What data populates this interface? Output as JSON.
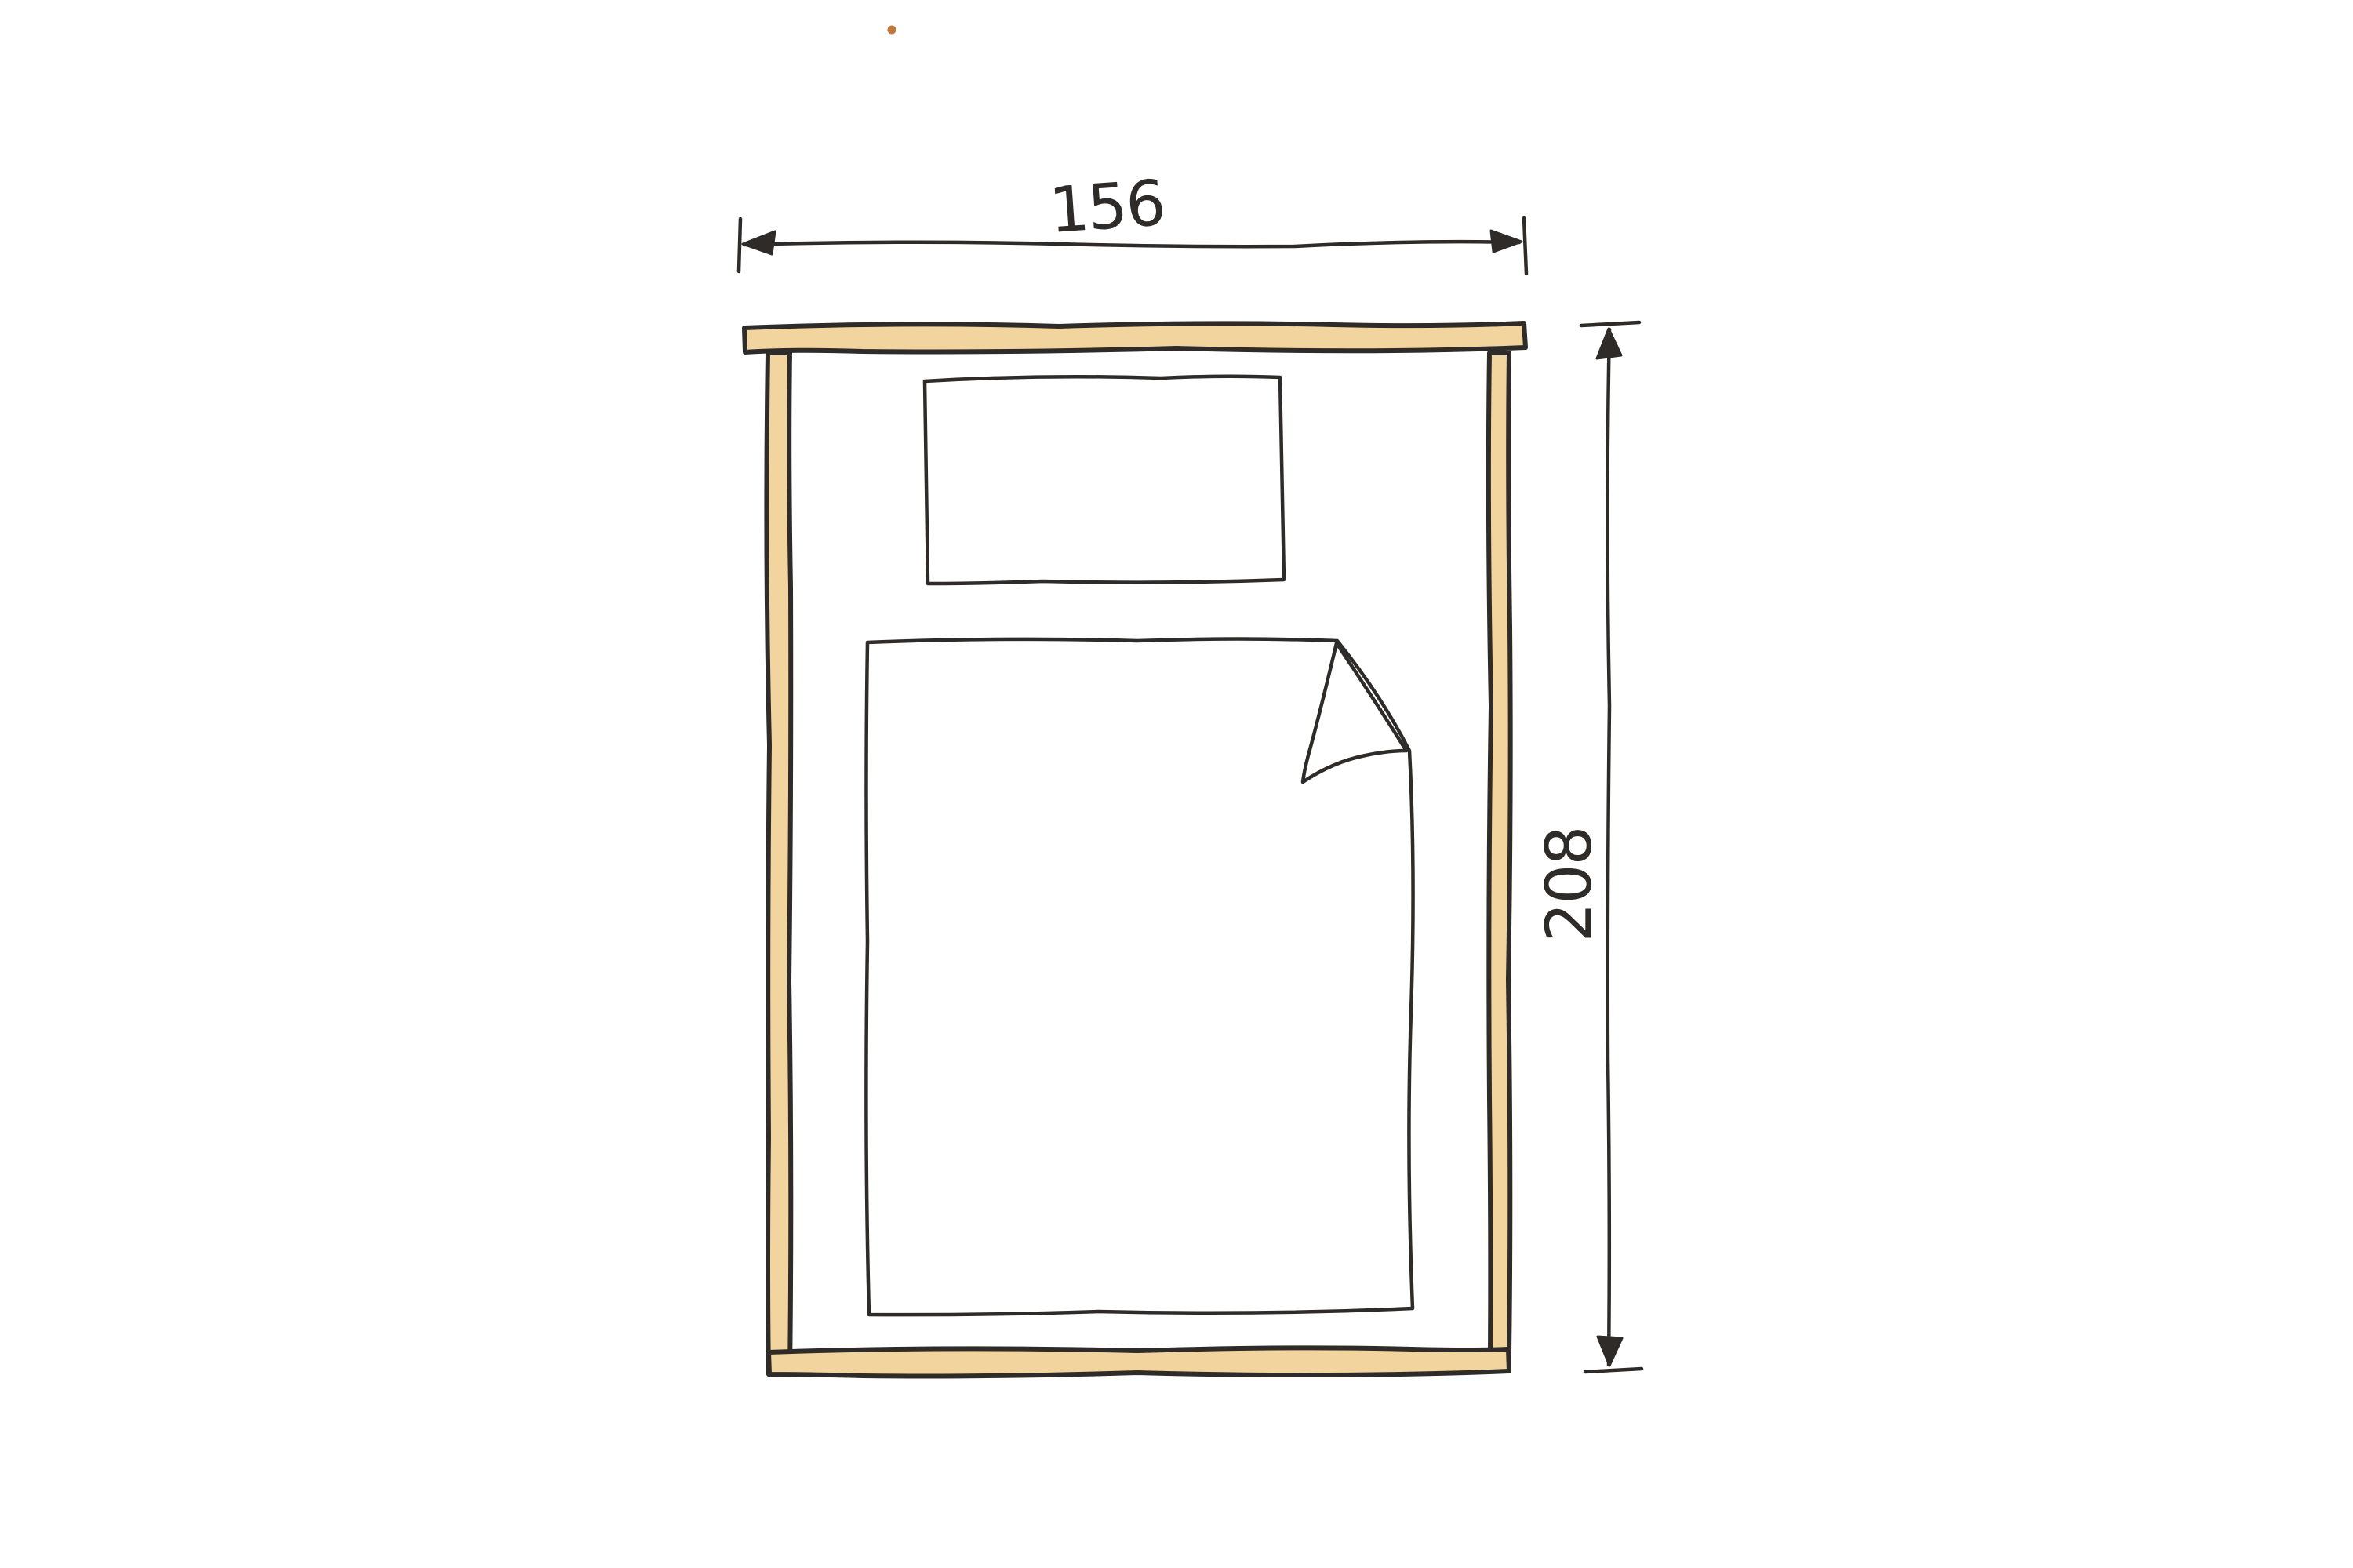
{
  "page": {
    "title": "Hand-drawn bed sketch with dimensions"
  },
  "colors": {
    "wood": "#f2d49e",
    "ink": "#2e2b28",
    "paper": "#ffffff",
    "speck": "#c07a3e"
  },
  "drawing": {
    "subject": "bed top view, hand-drawn pencil-and-marker style",
    "dimensions": {
      "width": {
        "value": "156",
        "orientation": "horizontal",
        "position": "above bed"
      },
      "height": {
        "value": "208",
        "orientation": "vertical",
        "position": "right of bed"
      }
    },
    "parts": [
      "headboard-rail",
      "left-side-rail",
      "right-side-rail",
      "foot-rail",
      "pillow",
      "duvet",
      "duvet-folded-corner"
    ]
  }
}
